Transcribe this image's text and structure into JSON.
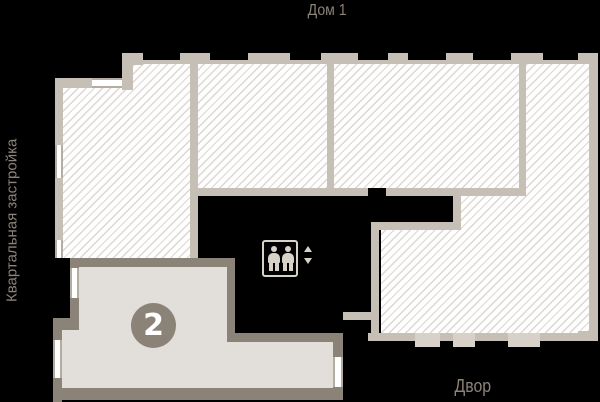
{
  "scene": {
    "background_color": "#000000",
    "labels": {
      "house": "Дом 1",
      "district": "Квартальная застройка",
      "yard": "Двор"
    },
    "selected_unit": {
      "number": "2",
      "fill_color": "#e2dfda",
      "wall_color": "#8b8377",
      "badge_color": "#8b8377",
      "badge_text_color": "#ffffff"
    },
    "palette": {
      "light_wall": "#c6bfb6",
      "hatch_line": "#ddd7d1",
      "hatch_background": "#fefefe",
      "window_frame": "#b3aca2",
      "icon_color": "#d8d2c8",
      "label_color": "#8c8379"
    },
    "icons": {
      "elevator": "elevator-icon"
    }
  }
}
